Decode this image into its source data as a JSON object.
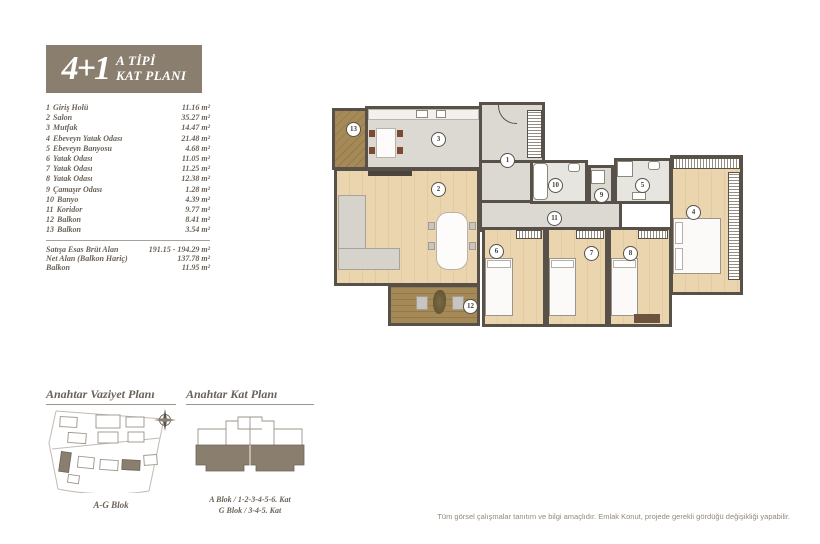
{
  "badge": {
    "units": "4+1",
    "title_line1": "A TİPİ",
    "title_line2": "KAT PLANI"
  },
  "room_list": {
    "items": [
      {
        "no": "1",
        "name": "Giriş Holü",
        "area": "11.16 m²"
      },
      {
        "no": "2",
        "name": "Salon",
        "area": "35.27 m²"
      },
      {
        "no": "3",
        "name": "Mutfak",
        "area": "14.47 m²"
      },
      {
        "no": "4",
        "name": "Ebeveyn Yatak Odası",
        "area": "21.48 m²"
      },
      {
        "no": "5",
        "name": "Ebeveyn Banyosu",
        "area": "4.68 m²"
      },
      {
        "no": "6",
        "name": "Yatak Odası",
        "area": "11.05 m²"
      },
      {
        "no": "7",
        "name": "Yatak Odası",
        "area": "11.25 m²"
      },
      {
        "no": "8",
        "name": "Yatak Odası",
        "area": "12.38 m²"
      },
      {
        "no": "9",
        "name": "Çamaşır Odası",
        "area": "1.28 m²"
      },
      {
        "no": "10",
        "name": "Banyo",
        "area": "4.39 m²"
      },
      {
        "no": "11",
        "name": "Koridor",
        "area": "9.77 m²"
      },
      {
        "no": "12",
        "name": "Balkon",
        "area": "8.41 m²"
      },
      {
        "no": "13",
        "name": "Balkon",
        "area": "3.54 m²"
      }
    ],
    "summary": [
      {
        "label": "Satışa Esas Brüt Alan",
        "value": "191.15 - 194.29 m²"
      },
      {
        "label": "Net Alan (Balkon Hariç)",
        "value": "137.78 m²"
      },
      {
        "label": "Balkon",
        "value": "11.95 m²"
      }
    ]
  },
  "floor_plan": {
    "room_numbers": [
      "1",
      "2",
      "3",
      "4",
      "5",
      "6",
      "7",
      "8",
      "9",
      "10",
      "11",
      "12",
      "13"
    ]
  },
  "key_site_plan": {
    "title": "Anahtar Vaziyet Planı",
    "caption": "A-G Blok"
  },
  "key_floor_plan": {
    "title": "Anahtar Kat Planı",
    "caption_line1": "A Blok / 1-2-3-4-5-6. Kat",
    "caption_line2": "G Blok / 3-4-5. Kat"
  },
  "footer": {
    "disclaimer": "Tüm görsel çalışmalar tanıtım ve bilgi amaçlıdır. Emlak Konut, projede gerekli gördüğü değişikliği yapabilir."
  },
  "colors": {
    "accent": "#8a7e6e",
    "wall": "#57514a",
    "gray_floor": "#dcd9d3",
    "wood_floor": "#ebd5ae",
    "deck": "#a58a58",
    "text": "#6b6258"
  }
}
